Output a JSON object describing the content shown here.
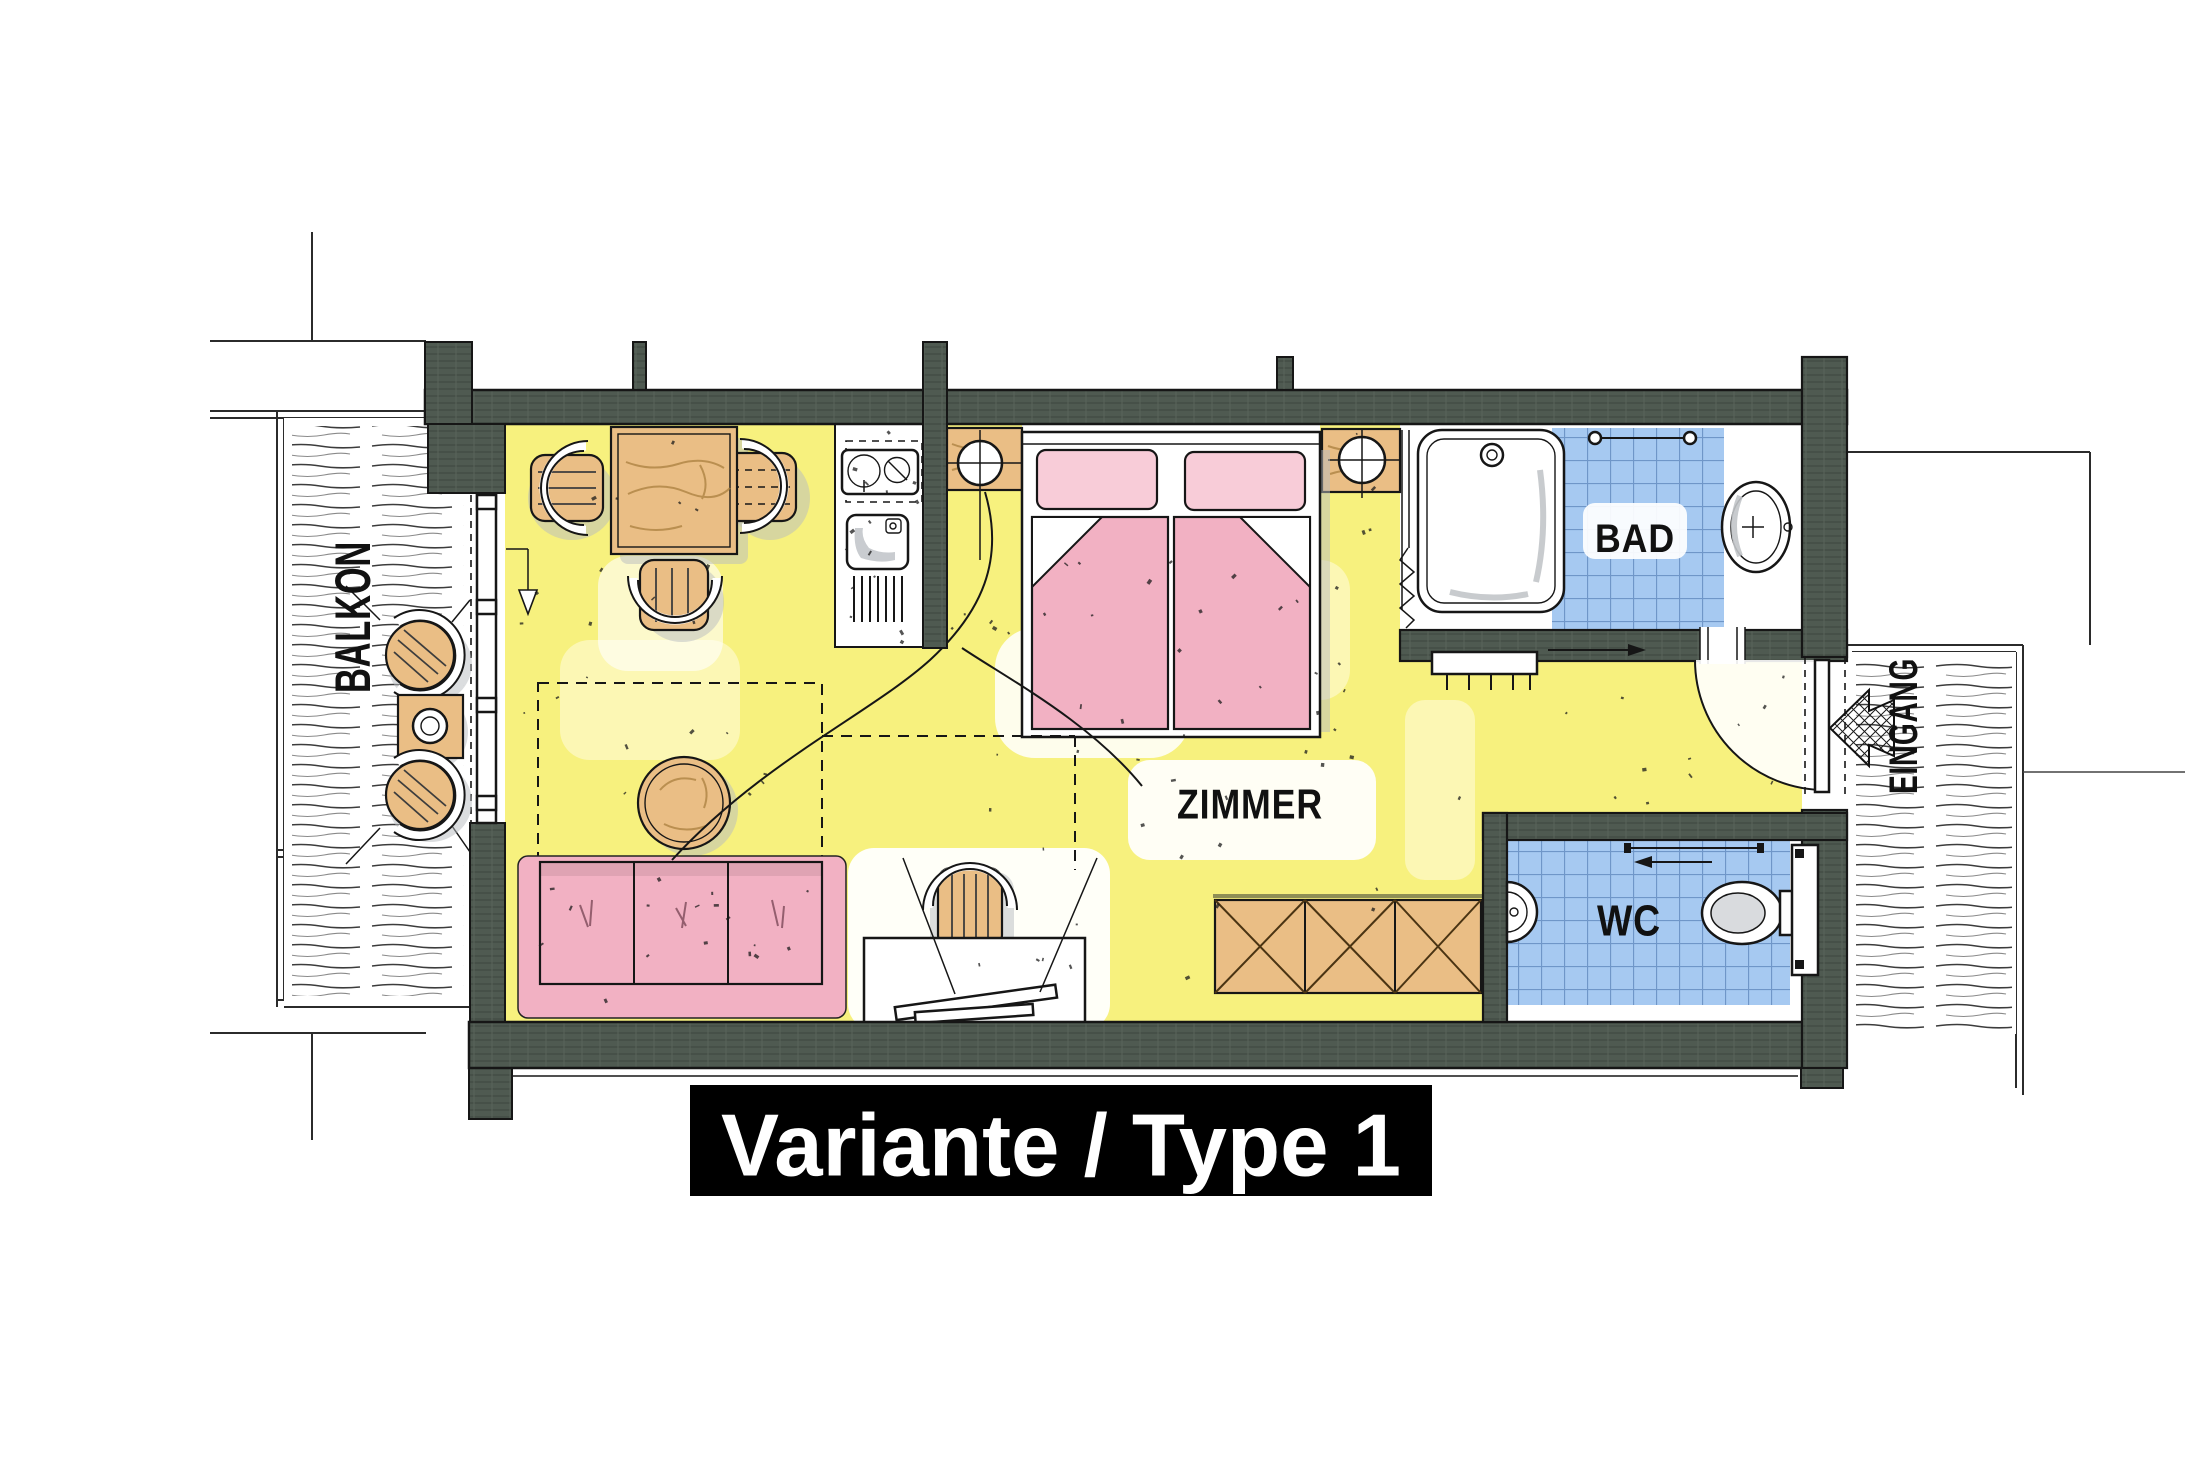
{
  "title_banner": {
    "label": "Variante / Type 1"
  },
  "labels": {
    "balcony": "BALKON",
    "room": "ZIMMER",
    "bath": "BAD",
    "wc": "WC",
    "entrance": "EINGANG"
  },
  "colors": {
    "wall": "#4f5a51",
    "ink": "#161616",
    "floor": "#f7f17e",
    "floor_light": "#fcf7b4",
    "wood": "#eabe85",
    "wood_grain": "#a97f3f",
    "pink": "#f2b1c3",
    "pink_light": "#f8ccd8",
    "blue": "#a6c9f1",
    "tile_line": "#6f96c8",
    "shadow": "#b8bbbf",
    "banner_bg": "#000000",
    "banner_text": "#ffffff"
  }
}
